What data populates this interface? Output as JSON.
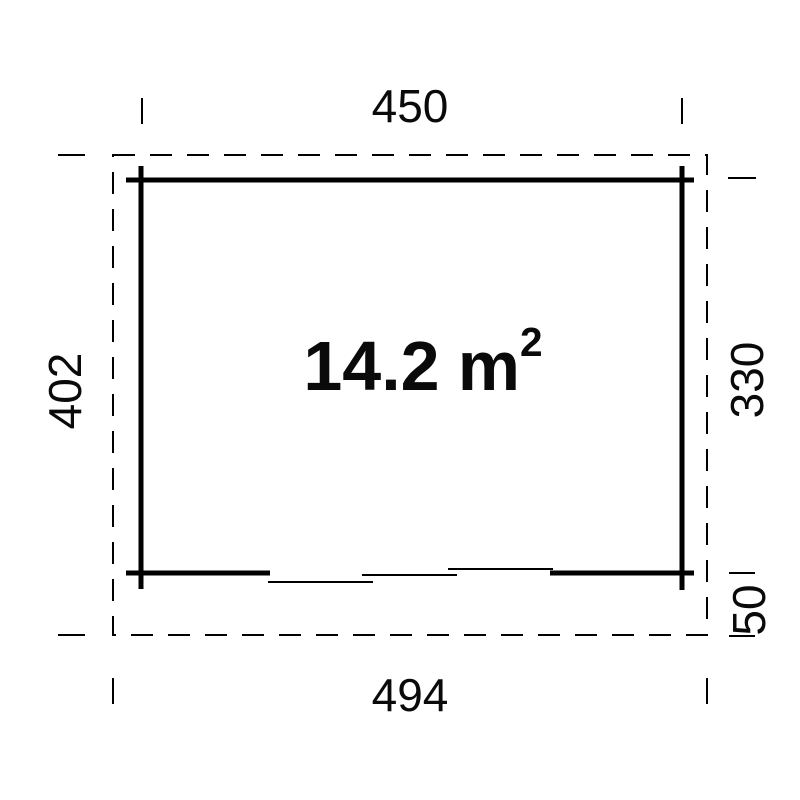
{
  "colors": {
    "background": "#ffffff",
    "line": "#000000",
    "text": "#0a0a0a"
  },
  "plan": {
    "area_label": {
      "value": "14.2",
      "unit": "m",
      "exponent": "2"
    },
    "dimensions": {
      "top_width": "450",
      "left_height": "402",
      "right_height": "330",
      "right_lower_offset": "50",
      "bottom_width": "494"
    }
  }
}
